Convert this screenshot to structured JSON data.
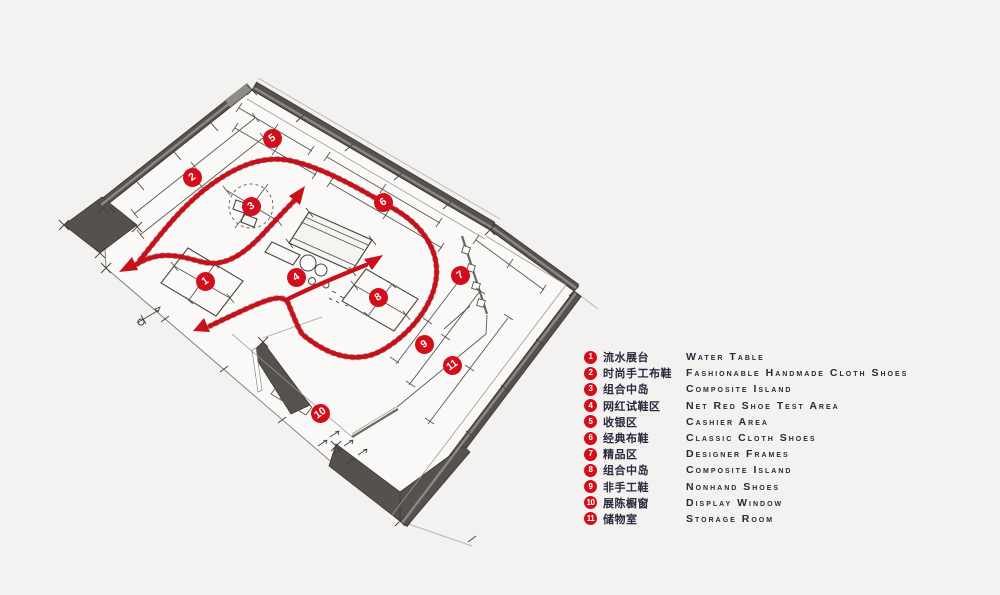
{
  "colors": {
    "background": "#f3f2f0",
    "floor": "#faf9f7",
    "wall_dark": "#55524d",
    "accent_red": "#d40d1d",
    "flow_red": "#c8101b",
    "ink": "#262a3c"
  },
  "plan": {
    "markers": [
      {
        "n": "1",
        "x": 205,
        "y": 281
      },
      {
        "n": "2",
        "x": 192,
        "y": 177
      },
      {
        "n": "3",
        "x": 251,
        "y": 206
      },
      {
        "n": "4",
        "x": 296,
        "y": 277
      },
      {
        "n": "5",
        "x": 272,
        "y": 138
      },
      {
        "n": "6",
        "x": 383,
        "y": 202
      },
      {
        "n": "7",
        "x": 460,
        "y": 275
      },
      {
        "n": "8",
        "x": 378,
        "y": 297
      },
      {
        "n": "9",
        "x": 424,
        "y": 344
      },
      {
        "n": "10",
        "x": 320,
        "y": 413
      },
      {
        "n": "11",
        "x": 452,
        "y": 365
      }
    ]
  },
  "legend": {
    "items": [
      {
        "n": "1",
        "zh": "流水展台",
        "en": "Water Table"
      },
      {
        "n": "2",
        "zh": "时尚手工布鞋",
        "en": "Fashionable Handmade Cloth Shoes"
      },
      {
        "n": "3",
        "zh": "组合中岛",
        "en": "Composite Island"
      },
      {
        "n": "4",
        "zh": "网红试鞋区",
        "en": "Net Red Shoe Test Area"
      },
      {
        "n": "5",
        "zh": "收银区",
        "en": "Cashier Area"
      },
      {
        "n": "6",
        "zh": "经典布鞋",
        "en": "Classic Cloth Shoes"
      },
      {
        "n": "7",
        "zh": "精品区",
        "en": "Designer Frames"
      },
      {
        "n": "8",
        "zh": "组合中岛",
        "en": "Composite Island"
      },
      {
        "n": "9",
        "zh": "非手工鞋",
        "en": "Nonhand Shoes"
      },
      {
        "n": "10",
        "zh": "展陈橱窗",
        "en": "Display Window"
      },
      {
        "n": "11",
        "zh": "储物室",
        "en": "Storage Room"
      }
    ]
  }
}
